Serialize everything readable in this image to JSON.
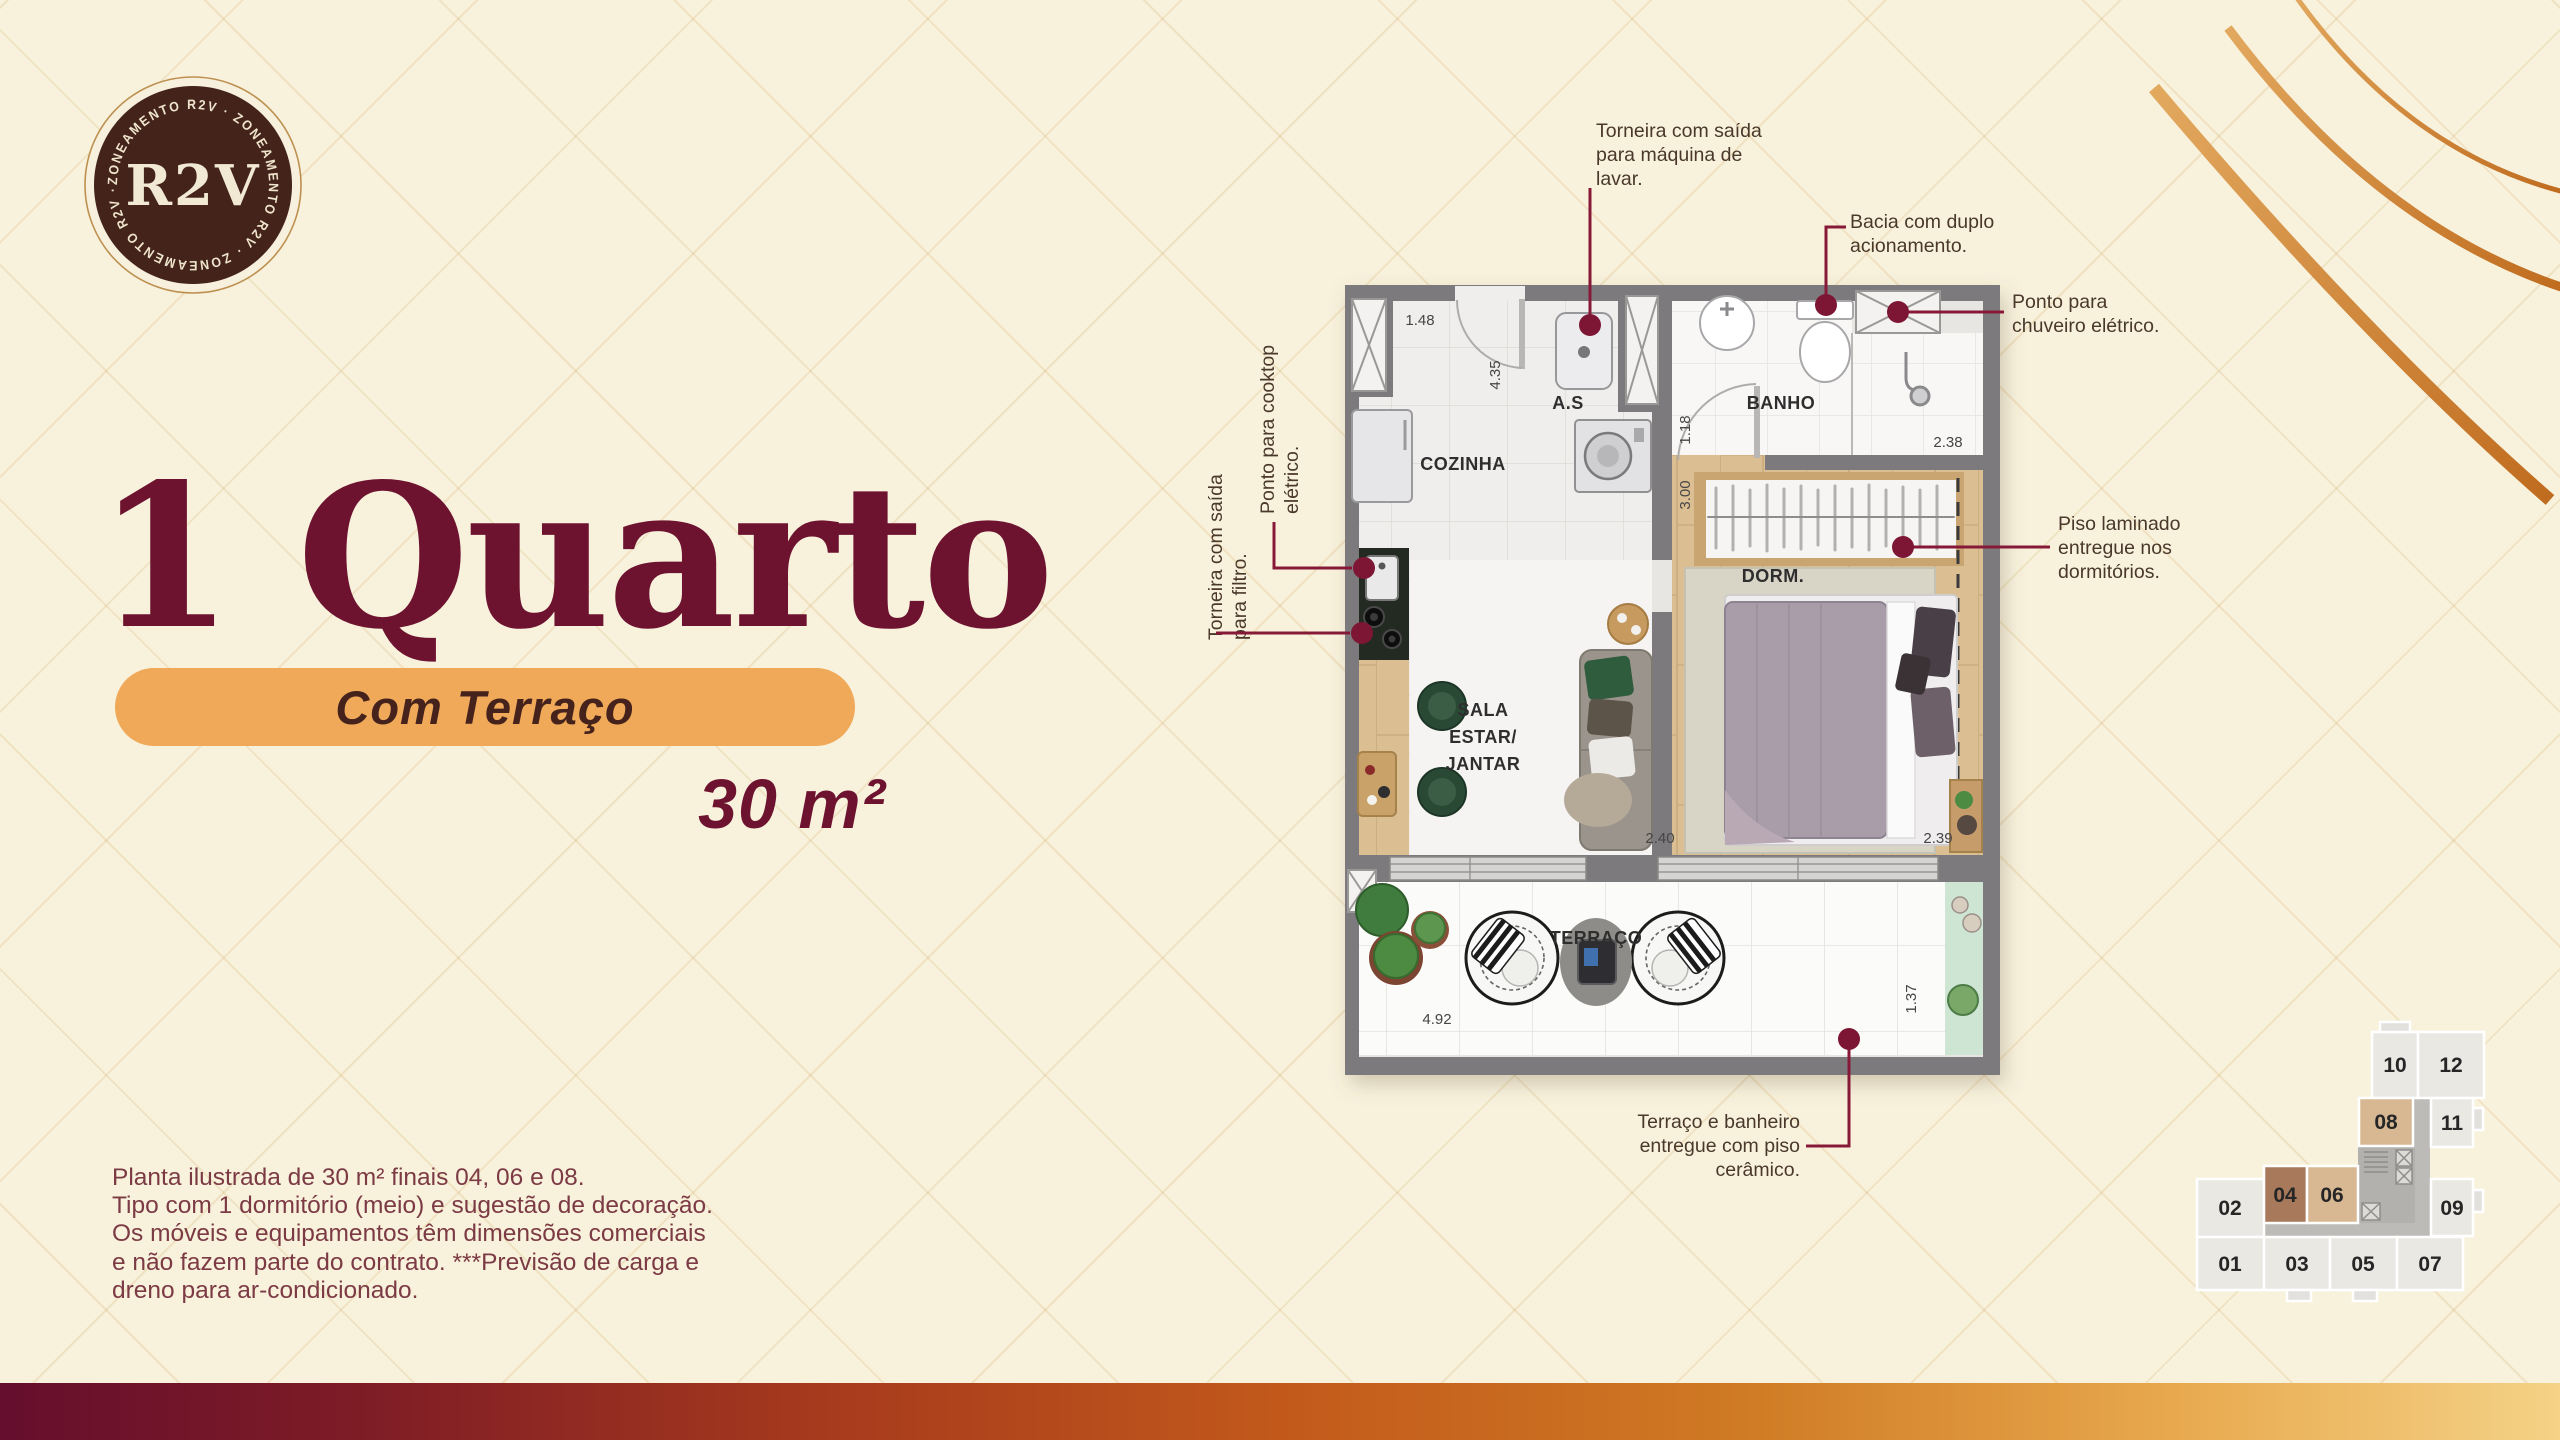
{
  "badge": {
    "ring_text": "ZONEAMENTO R2V · ZONEAMENTO R2V · ZONEAMENTO R2V ·",
    "center": "R2V"
  },
  "hero": {
    "title": "1 Quarto",
    "subtitle": "Com Terraço",
    "area": "30 m²"
  },
  "disclaimer": {
    "l1": "Planta ilustrada de 30 m² finais 04, 06 e 08.",
    "l2": "Tipo com 1 dormitório (meio) e sugestão de decoração.",
    "l3": "Os móveis e equipamentos têm dimensões comerciais",
    "l4": "e não fazem parte do contrato. ***Previsão de carga e",
    "l5": "dreno para ar-condicionado."
  },
  "callouts": {
    "maquina": {
      "l1": "Torneira com saída",
      "l2": "para máquina de",
      "l3": "lavar."
    },
    "bacia": {
      "l1": "Bacia com duplo",
      "l2": "acionamento."
    },
    "chuveiro": {
      "l1": "Ponto para",
      "l2": "chuveiro elétrico."
    },
    "piso": {
      "l1": "Piso laminado",
      "l2": "entregue nos",
      "l3": "dormitórios."
    },
    "cooktop": {
      "l1": "Ponto para cooktop",
      "l2": "elétrico."
    },
    "filtro": {
      "l1": "Torneira com saída",
      "l2": "para filtro."
    },
    "ceramico": {
      "l1": "Terraço e banheiro",
      "l2": "entregue com piso",
      "l3": "cerâmico."
    }
  },
  "floorplan": {
    "rooms": {
      "as": "A.S",
      "cozinha": "COZINHA",
      "banho": "BANHO",
      "dorm": "DORM.",
      "sala1": "SALA",
      "sala2": "ESTAR/",
      "sala3": "JANTAR",
      "terraco": "TERRAÇO"
    },
    "dims": {
      "d148": "1.48",
      "d435": "4.35",
      "d118": "1.18",
      "d238": "2.38",
      "d300": "3.00",
      "d240": "2.40",
      "d239": "2.39",
      "d492": "4.92",
      "d137": "1.37"
    }
  },
  "keyplan": {
    "units": [
      "10",
      "12",
      "08",
      "11",
      "02",
      "04",
      "06",
      "09",
      "01",
      "03",
      "05",
      "07"
    ]
  },
  "colors": {
    "maroon": "#6d1330",
    "callout_line": "#871938",
    "pill_orange": "#efa958",
    "highlight_tan": "#d7b893",
    "highlight_brown": "#a8795a",
    "gradient_left": "#650e2d",
    "gradient_right": "#f4d287"
  }
}
